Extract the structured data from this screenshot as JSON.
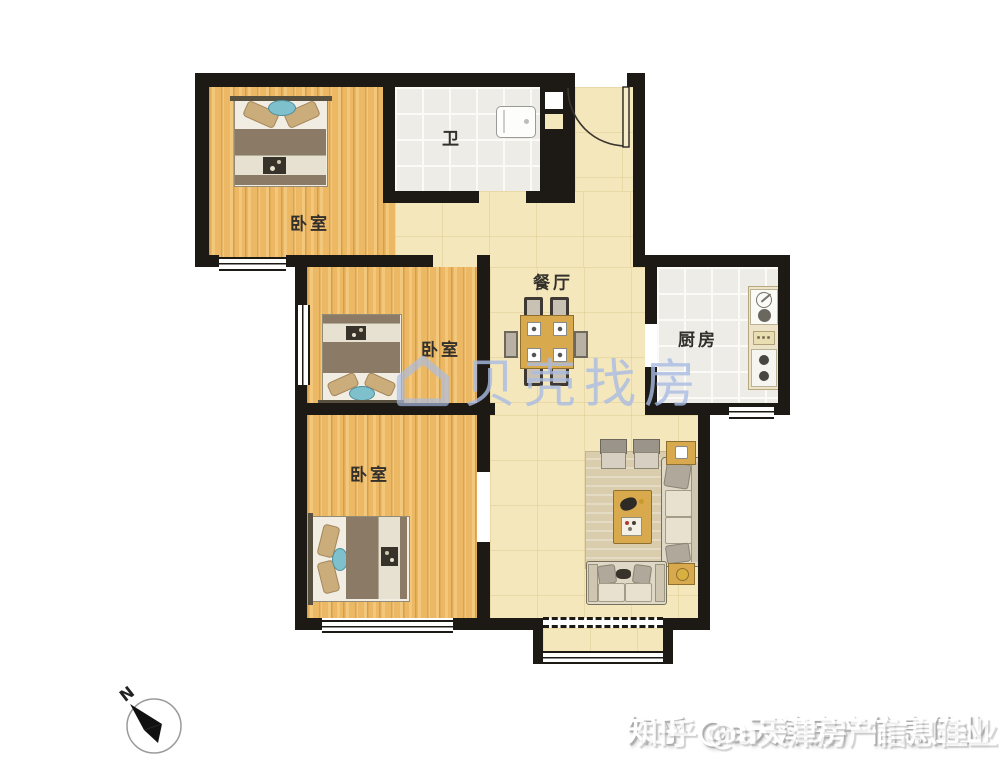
{
  "plan": {
    "type": "apartment-floor-plan",
    "rooms": {
      "bedroom_top": {
        "label": "卧室"
      },
      "bathroom": {
        "label": "卫"
      },
      "dining": {
        "label": "餐厅"
      },
      "kitchen": {
        "label": "厨房"
      },
      "bedroom_middle": {
        "label": "卧室"
      },
      "bedroom_bottom": {
        "label": "卧室"
      }
    },
    "furniture": {
      "bedroom_top": [
        "double-bed"
      ],
      "bedroom_middle": [
        "double-bed"
      ],
      "bedroom_bottom": [
        "double-bed"
      ],
      "bathroom": [
        "washing-machine"
      ],
      "kitchen": [
        "counter-with-sink-and-stove"
      ],
      "dining": [
        "dining-table",
        "four-chairs",
        "two-stools"
      ],
      "living": [
        "three-seat-sofa",
        "loveseat",
        "two-armchairs",
        "coffee-table",
        "two-side-tables",
        "rug"
      ]
    },
    "features": [
      "entry-door-swing",
      "bay-window",
      "balcony-dashed-line",
      "wall-shaft-niches"
    ]
  },
  "watermarks": {
    "beike": {
      "icon": "house-logo-icon",
      "text": "贝壳找房",
      "color": "#a9bce4"
    },
    "zhihu": {
      "text": "知乎 @a天津房产信息佳业",
      "color": "#ffffff"
    }
  },
  "compass": {
    "label": "N",
    "direction": "north-up-left"
  },
  "colors": {
    "wall": "#1d1a16",
    "wood_floor": "#edb863",
    "tile_floor": "#edece6",
    "marble_floor": "#f4e7bb",
    "furniture_taupe": "#8a7a66",
    "furniture_wood": "#d9a94e",
    "accent_teal": "#7fc0cd",
    "watermark_blue": "#a9bce4"
  }
}
